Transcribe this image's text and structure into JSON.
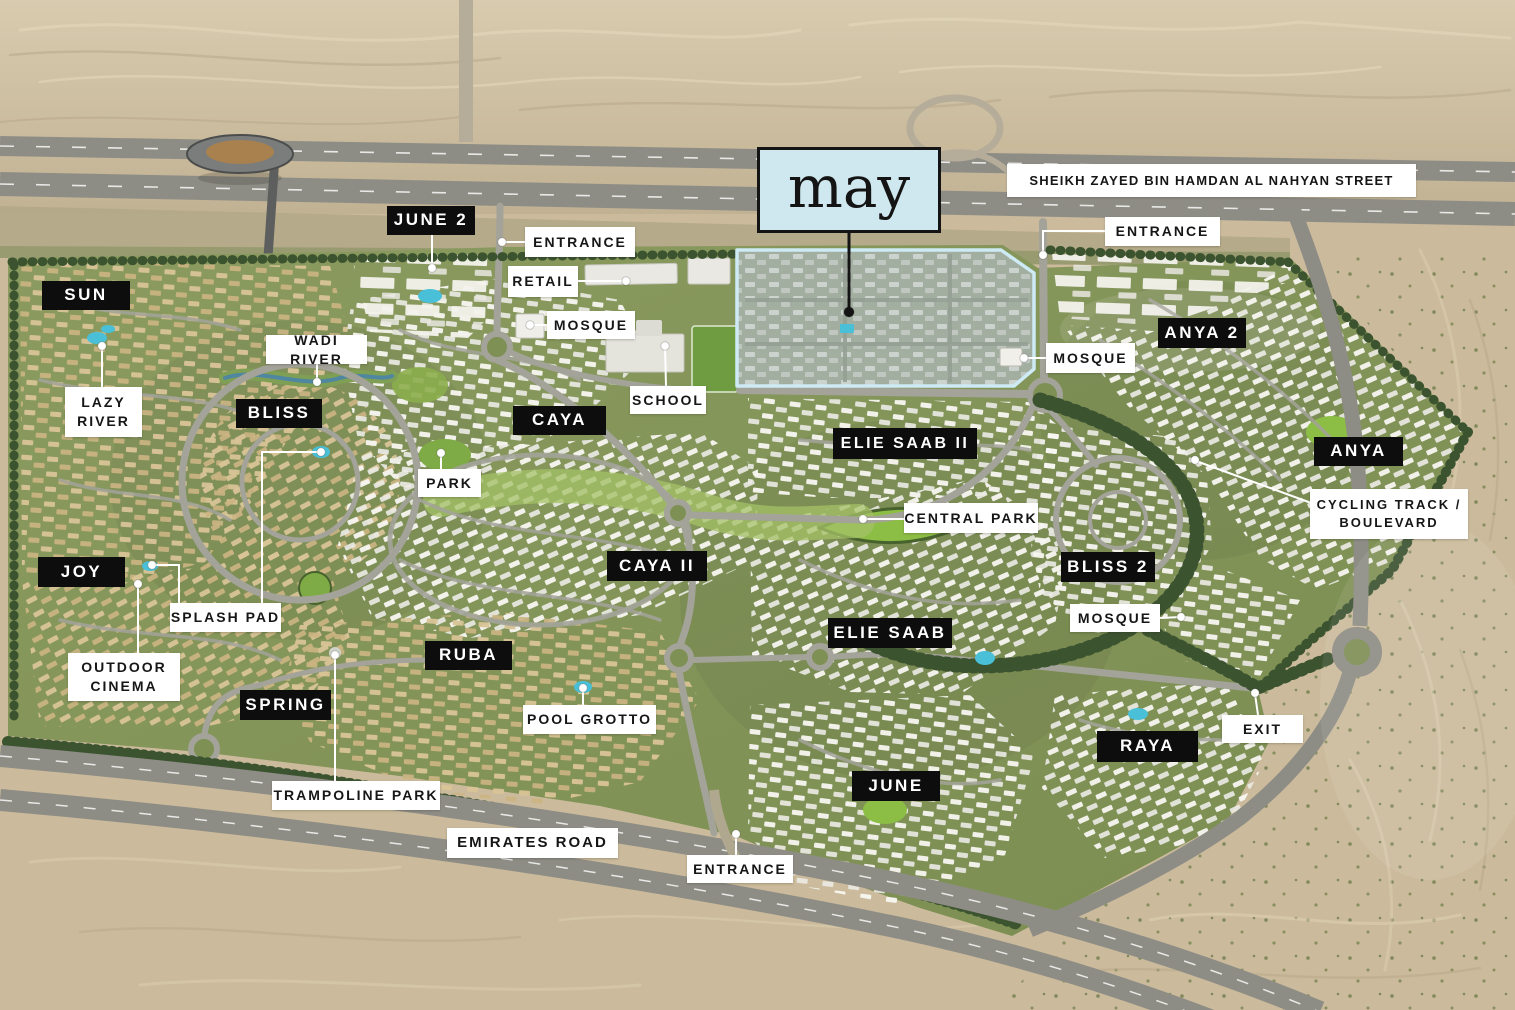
{
  "logo": {
    "text": "may",
    "x": 757,
    "y": 147,
    "w": 184,
    "h": 86,
    "bg": "#cfe8ef",
    "border": "#141414",
    "leader": {
      "points": [
        [
          849,
          233
        ],
        [
          849,
          312
        ]
      ],
      "dot": [
        849,
        312
      ],
      "color": "#141414"
    }
  },
  "colors": {
    "label_black_bg": "#0d0d0d",
    "label_black_text": "#ffffff",
    "label_white_bg": "#ffffff",
    "label_white_text": "#161616",
    "parcel_outline": "#cdeaf5",
    "desert": "#cbbb9c",
    "greenery": "#84955a",
    "road": "#8e8d85",
    "pool": "#49c0d8",
    "leader_line": "#ffffff"
  },
  "labels": [
    {
      "id": "street-sheikh-zayed",
      "style": "white",
      "text": "SHEIKH ZAYED BIN HAMDAN AL NAHYAN STREET",
      "x": 1007,
      "y": 164,
      "w": 409,
      "h": 33,
      "fs": 13,
      "ls": 1.2
    },
    {
      "id": "june-2",
      "style": "black",
      "text": "JUNE 2",
      "x": 387,
      "y": 206,
      "w": 88,
      "h": 29,
      "leaders": [
        {
          "points": [
            [
              432,
              235
            ],
            [
              432,
              268
            ]
          ],
          "dot": [
            432,
            268
          ]
        }
      ]
    },
    {
      "id": "entrance-north",
      "style": "white",
      "text": "ENTRANCE",
      "x": 525,
      "y": 227,
      "w": 110,
      "h": 30,
      "leaders": [
        {
          "points": [
            [
              525,
              242
            ],
            [
              502,
              242
            ]
          ],
          "dot": [
            502,
            242
          ]
        }
      ]
    },
    {
      "id": "retail",
      "style": "white",
      "text": "RETAIL",
      "x": 508,
      "y": 266,
      "w": 70,
      "h": 31,
      "leaders": [
        {
          "points": [
            [
              578,
              281
            ],
            [
              626,
              281
            ]
          ],
          "dot": [
            626,
            281
          ]
        }
      ]
    },
    {
      "id": "mosque-north",
      "style": "white",
      "text": "MOSQUE",
      "x": 547,
      "y": 311,
      "w": 88,
      "h": 28,
      "leaders": [
        {
          "points": [
            [
              547,
              325
            ],
            [
              530,
              325
            ]
          ],
          "dot": [
            530,
            325
          ]
        }
      ]
    },
    {
      "id": "school",
      "style": "white",
      "text": "SCHOOL",
      "x": 630,
      "y": 386,
      "w": 76,
      "h": 28,
      "leaders": [
        {
          "points": [
            [
              666,
              386
            ],
            [
              665,
              346
            ]
          ],
          "dot": [
            665,
            346
          ]
        }
      ]
    },
    {
      "id": "sun",
      "style": "black",
      "text": "SUN",
      "x": 42,
      "y": 281,
      "w": 88,
      "h": 29
    },
    {
      "id": "wadi-river",
      "style": "white",
      "text": "WADI RIVER",
      "x": 266,
      "y": 335,
      "w": 101,
      "h": 29,
      "leaders": [
        {
          "points": [
            [
              317,
              364
            ],
            [
              317,
              382
            ]
          ],
          "dot": [
            317,
            382
          ]
        }
      ]
    },
    {
      "id": "lazy-river",
      "style": "white",
      "text": "LAZY\nRIVER",
      "x": 65,
      "y": 387,
      "w": 77,
      "h": 50,
      "leaders": [
        {
          "points": [
            [
              102,
              387
            ],
            [
              102,
              346
            ]
          ],
          "dot": [
            102,
            346
          ]
        }
      ]
    },
    {
      "id": "bliss",
      "style": "black",
      "text": "BLISS",
      "x": 236,
      "y": 399,
      "w": 86,
      "h": 29
    },
    {
      "id": "caya",
      "style": "black",
      "text": "CAYA",
      "x": 513,
      "y": 406,
      "w": 93,
      "h": 29
    },
    {
      "id": "park",
      "style": "white",
      "text": "PARK",
      "x": 418,
      "y": 469,
      "w": 63,
      "h": 28,
      "leaders": [
        {
          "points": [
            [
              441,
              469
            ],
            [
              441,
              453
            ]
          ],
          "dot": [
            441,
            453
          ]
        }
      ]
    },
    {
      "id": "elie-saab-ii",
      "style": "black",
      "text": "ELIE SAAB II",
      "x": 833,
      "y": 428,
      "w": 144,
      "h": 31,
      "fs": 16
    },
    {
      "id": "central-park",
      "style": "white",
      "text": "CENTRAL PARK",
      "x": 904,
      "y": 503,
      "w": 134,
      "h": 30,
      "leaders": [
        {
          "points": [
            [
              904,
              519
            ],
            [
              863,
              519
            ]
          ],
          "dot": [
            863,
            519
          ]
        }
      ]
    },
    {
      "id": "anya-2",
      "style": "black",
      "text": "ANYA 2",
      "x": 1158,
      "y": 318,
      "w": 88,
      "h": 30
    },
    {
      "id": "entrance-east",
      "style": "white",
      "text": "ENTRANCE",
      "x": 1105,
      "y": 217,
      "w": 115,
      "h": 29,
      "leaders": [
        {
          "points": [
            [
              1105,
              231
            ],
            [
              1043,
              231
            ],
            [
              1043,
              255
            ]
          ],
          "dot": [
            1043,
            255
          ]
        }
      ]
    },
    {
      "id": "mosque-may",
      "style": "white",
      "text": "MOSQUE",
      "x": 1046,
      "y": 343,
      "w": 89,
      "h": 30,
      "leaders": [
        {
          "points": [
            [
              1046,
              358
            ],
            [
              1024,
              358
            ]
          ],
          "dot": [
            1024,
            358
          ]
        }
      ]
    },
    {
      "id": "anya",
      "style": "black",
      "text": "ANYA",
      "x": 1314,
      "y": 437,
      "w": 89,
      "h": 29
    },
    {
      "id": "cycling-track-boulevard",
      "style": "white",
      "text": "CYCLING TRACK /\nBOULEVARD",
      "x": 1310,
      "y": 489,
      "w": 158,
      "h": 50,
      "fs": 13,
      "leaders": [
        {
          "points": [
            [
              1314,
              504
            ],
            [
              1196,
              461
            ]
          ],
          "dot": [
            1195,
            460
          ]
        }
      ]
    },
    {
      "id": "caya-ii",
      "style": "black",
      "text": "CAYA II",
      "x": 607,
      "y": 551,
      "w": 100,
      "h": 30
    },
    {
      "id": "joy",
      "style": "black",
      "text": "JOY",
      "x": 38,
      "y": 557,
      "w": 87,
      "h": 30
    },
    {
      "id": "splash-pad",
      "style": "white",
      "text": "SPLASH PAD",
      "x": 170,
      "y": 603,
      "w": 111,
      "h": 29,
      "leaders": [
        {
          "points": [
            [
              179,
              603
            ],
            [
              179,
              565
            ],
            [
              152,
              565
            ]
          ],
          "dot": [
            152,
            565
          ]
        },
        {
          "points": [
            [
              262,
              603
            ],
            [
              262,
              452
            ],
            [
              321,
              452
            ]
          ],
          "dot": [
            321,
            452
          ]
        }
      ]
    },
    {
      "id": "bliss-2",
      "style": "black",
      "text": "BLISS 2",
      "x": 1061,
      "y": 552,
      "w": 94,
      "h": 30
    },
    {
      "id": "mosque-bliss-2",
      "style": "white",
      "text": "MOSQUE",
      "x": 1070,
      "y": 604,
      "w": 90,
      "h": 28,
      "leaders": [
        {
          "points": [
            [
              1160,
              618
            ],
            [
              1181,
              617
            ]
          ],
          "dot": [
            1181,
            617
          ]
        }
      ]
    },
    {
      "id": "outdoor-cinema",
      "style": "white",
      "text": "OUTDOOR\nCINEMA",
      "x": 68,
      "y": 653,
      "w": 112,
      "h": 48,
      "leaders": [
        {
          "points": [
            [
              138,
              653
            ],
            [
              138,
              584
            ]
          ],
          "dot": [
            138,
            584
          ]
        }
      ]
    },
    {
      "id": "ruba",
      "style": "black",
      "text": "RUBA",
      "x": 425,
      "y": 641,
      "w": 87,
      "h": 29
    },
    {
      "id": "elie-saab",
      "style": "black",
      "text": "ELIE SAAB",
      "x": 828,
      "y": 618,
      "w": 124,
      "h": 30
    },
    {
      "id": "spring",
      "style": "black",
      "text": "SPRING",
      "x": 240,
      "y": 690,
      "w": 91,
      "h": 30
    },
    {
      "id": "pool-grotto",
      "style": "white",
      "text": "POOL GROTTO",
      "x": 523,
      "y": 705,
      "w": 133,
      "h": 29,
      "leaders": [
        {
          "points": [
            [
              583,
              705
            ],
            [
              583,
              688
            ]
          ],
          "dot": [
            583,
            688
          ]
        }
      ]
    },
    {
      "id": "raya",
      "style": "black",
      "text": "RAYA",
      "x": 1097,
      "y": 731,
      "w": 101,
      "h": 31
    },
    {
      "id": "exit",
      "style": "white",
      "text": "EXIT",
      "x": 1222,
      "y": 715,
      "w": 81,
      "h": 28,
      "leaders": [
        {
          "points": [
            [
              1258,
              715
            ],
            [
              1255,
              694
            ]
          ],
          "dot": [
            1255,
            693
          ]
        }
      ]
    },
    {
      "id": "june",
      "style": "black",
      "text": "JUNE",
      "x": 852,
      "y": 771,
      "w": 88,
      "h": 30
    },
    {
      "id": "trampoline-park",
      "style": "white",
      "text": "TRAMPOLINE PARK",
      "x": 272,
      "y": 781,
      "w": 168,
      "h": 29,
      "leaders": [
        {
          "points": [
            [
              335,
              781
            ],
            [
              335,
              655
            ]
          ],
          "dot": [
            335,
            655
          ]
        }
      ]
    },
    {
      "id": "emirates-road",
      "style": "white",
      "text": "EMIRATES ROAD",
      "x": 447,
      "y": 828,
      "w": 171,
      "h": 30,
      "fs": 15
    },
    {
      "id": "entrance-south",
      "style": "white",
      "text": "ENTRANCE",
      "x": 687,
      "y": 855,
      "w": 106,
      "h": 28,
      "leaders": [
        {
          "points": [
            [
              736,
              855
            ],
            [
              736,
              834
            ]
          ],
          "dot": [
            736,
            834
          ]
        }
      ]
    }
  ]
}
